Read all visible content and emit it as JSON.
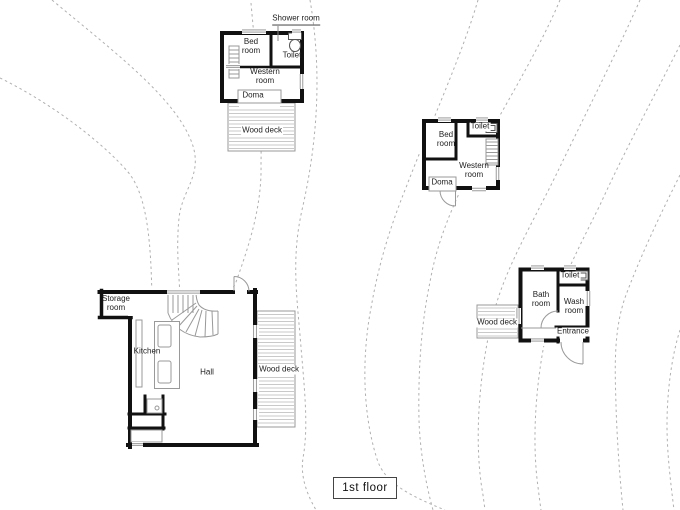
{
  "floor_label": "1st floor",
  "palette": {
    "wall": "#111111",
    "contour": "#b0b0b0",
    "deck_line": "#999999",
    "text": "#222222"
  },
  "cottage_a": {
    "shower_room": "Shower room",
    "bed_room": "Bed room",
    "toilet": "Toilet",
    "western_room": "Western room",
    "doma": "Doma",
    "wood_deck": "Wood deck"
  },
  "cottage_b": {
    "bed_room": "Bed room",
    "toilet": "Toilet",
    "western_room": "Western room",
    "doma": "Doma"
  },
  "bath_house": {
    "bath_room": "Bath room",
    "toilet": "Toilet",
    "wash_room": "Wash room",
    "entrance": "Entrance",
    "wood_deck": "Wood deck"
  },
  "main_house": {
    "storage_room": "Storage room",
    "kitchen": "Kitchen",
    "hall": "Hall",
    "wood_deck": "Wood deck"
  }
}
